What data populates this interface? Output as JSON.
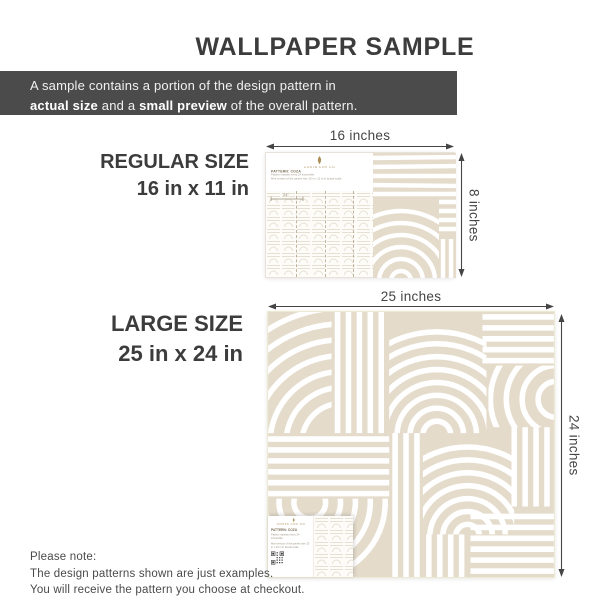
{
  "title": "WALLPAPER SAMPLE",
  "banner": {
    "line1": "A sample contains a portion of the design pattern in",
    "line2_bold1": "actual size",
    "line2_mid": " and a ",
    "line2_bold2": "small preview",
    "line2_end": " of the overall pattern."
  },
  "regular": {
    "name": "REGULAR SIZE",
    "size": "16 in x 11 in",
    "width_label": "16 inches",
    "height_label": "8 inches"
  },
  "large": {
    "name": "LARGE SIZE",
    "size": "25 in x 24 in",
    "width_label": "25 inches",
    "height_label": "24 inches"
  },
  "sample_label": {
    "brand": "COSTA COV CO",
    "pattern_name": "PATTERN: COZA",
    "info_line1": "Pattern repeats every 24 inches/tile.",
    "info_line2": "Mini version of the panels size 16 in x 11 in in actual scale.",
    "repeat_marker": "24\""
  },
  "large_label": {
    "info_line2": "Mini version of the panels size 25 in x 24 in in actual scale."
  },
  "footer": {
    "note_title": "Please note:",
    "line1": "The design patterns shown are just examples.",
    "line2": "You will receive the pattern you choose at checkout."
  },
  "colors": {
    "banner-bg": "#4b4b4b",
    "banner-text": "#f1f1f1",
    "ink": "#3c3c3c",
    "dim": "#454545",
    "beige": "#e4dbcb",
    "line": "#ffffff",
    "gold": "#ad9059",
    "faint": "#cfc4ae"
  }
}
